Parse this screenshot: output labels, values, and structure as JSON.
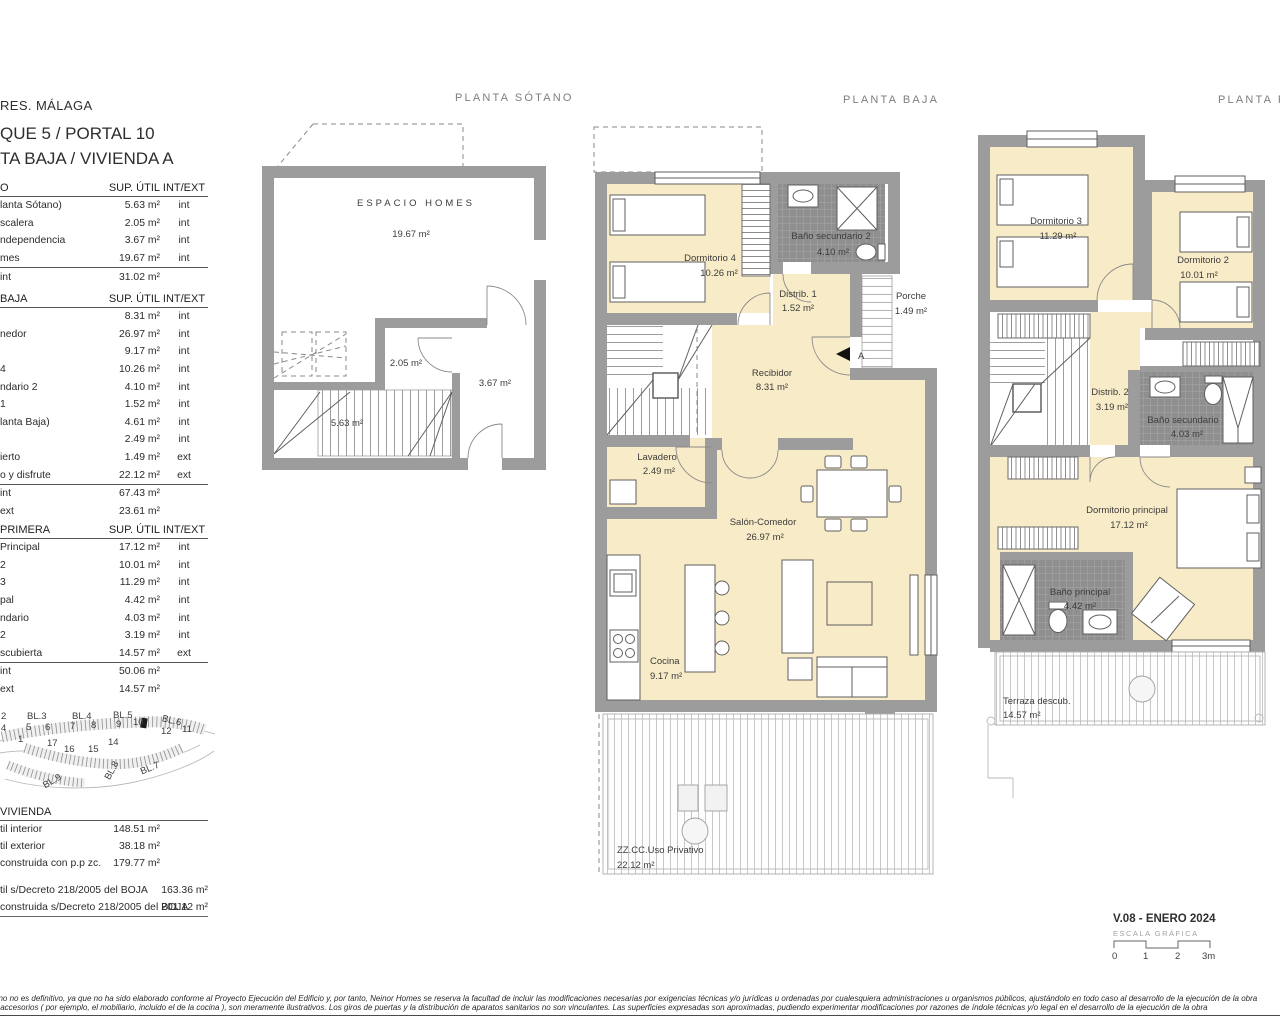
{
  "headers": {
    "sotano": "PLANTA SÓTANO",
    "baja": "PLANTA BAJA",
    "primera": "PLANTA PRIMERA"
  },
  "panel": {
    "project": "RES. MÁLAGA",
    "title_block": "QUE 5 / PORTAL 10",
    "title_unit": "TA BAJA / VIVIENDA A",
    "cols": {
      "sup": "SUP. ÚTIL",
      "zone": "INT/EXT"
    },
    "sotano": {
      "header": "O",
      "rows": [
        {
          "label": "lanta Sótano)",
          "value": "5.63 m²",
          "zone": "int"
        },
        {
          "label": "scalera",
          "value": "2.05 m²",
          "zone": "int"
        },
        {
          "label": "ndependencia",
          "value": "3.67 m²",
          "zone": "int"
        },
        {
          "label": "mes",
          "value": "19.67 m²",
          "zone": "int"
        }
      ],
      "totals": [
        {
          "label": "int",
          "value": "31.02 m²"
        }
      ]
    },
    "baja": {
      "header": "BAJA",
      "rows": [
        {
          "label": "",
          "value": "8.31 m²",
          "zone": "int"
        },
        {
          "label": "nedor",
          "value": "26.97 m²",
          "zone": "int"
        },
        {
          "label": "",
          "value": "9.17 m²",
          "zone": "int"
        },
        {
          "label": "4",
          "value": "10.26 m²",
          "zone": "int"
        },
        {
          "label": "ndario 2",
          "value": "4.10 m²",
          "zone": "int"
        },
        {
          "label": "1",
          "value": "1.52 m²",
          "zone": "int"
        },
        {
          "label": "lanta Baja)",
          "value": "4.61 m²",
          "zone": "int"
        },
        {
          "label": "",
          "value": "2.49 m²",
          "zone": "int"
        },
        {
          "label": "ierto",
          "value": "1.49 m²",
          "zone": "ext"
        },
        {
          "label": "o y disfrute",
          "value": "22.12 m²",
          "zone": "ext"
        }
      ],
      "totals": [
        {
          "label": "int",
          "value": "67.43 m²"
        },
        {
          "label": "ext",
          "value": "23.61 m²"
        }
      ]
    },
    "primera": {
      "header": "PRIMERA",
      "rows": [
        {
          "label": "Principal",
          "value": "17.12 m²",
          "zone": "int"
        },
        {
          "label": "2",
          "value": "10.01 m²",
          "zone": "int"
        },
        {
          "label": "3",
          "value": "11.29 m²",
          "zone": "int"
        },
        {
          "label": "pal",
          "value": "4.42 m²",
          "zone": "int"
        },
        {
          "label": "ndario",
          "value": "4.03 m²",
          "zone": "int"
        },
        {
          "label": "2",
          "value": "3.19 m²",
          "zone": "int"
        },
        {
          "label": "scubierta",
          "value": "14.57 m²",
          "zone": "ext"
        }
      ],
      "totals": [
        {
          "label": "int",
          "value": "50.06 m²"
        },
        {
          "label": "ext",
          "value": "14.57 m²"
        }
      ]
    },
    "vivienda": {
      "header": "VIVIENDA",
      "rows": [
        {
          "label": "til interior",
          "value": "148.51 m²"
        },
        {
          "label": "til exterior",
          "value": "38.18 m²"
        },
        {
          "label": "construida con p.p zc.",
          "value": "179.77 m²"
        }
      ],
      "boja": [
        {
          "label": "til s/Decreto 218/2005 del BOJA",
          "value": "163.36 m²"
        },
        {
          "label": "construida s/Decreto 218/2005 del BOJA",
          "value": "201.12 m²"
        }
      ]
    }
  },
  "siteplan": {
    "blocks": [
      "2",
      "BL.3",
      "BL.4",
      "BL.5",
      "BL.6",
      "BL.7",
      "BL.8",
      "BL.9"
    ],
    "units": [
      "1",
      "4",
      "5",
      "6",
      "7",
      "8",
      "9",
      "10",
      "11",
      "12",
      "14",
      "15",
      "16",
      "17"
    ]
  },
  "plans": {
    "sotano": {
      "name": "ESPACIO HOMES",
      "area": "19.67 m²",
      "escalera": "2.05 m²",
      "independencia": "3.67 m²",
      "escalera_sotano": "5.63 m²"
    },
    "baja": {
      "marker": "A",
      "dorm4": {
        "name": "Dormitorio 4",
        "area": "10.26 m²"
      },
      "bano2": {
        "name": "Baño secundario 2",
        "area": "4.10 m²"
      },
      "distrib1": {
        "name": "Distrib. 1",
        "area": "1.52 m²"
      },
      "porche": {
        "name": "Porche",
        "area": "1.49 m²"
      },
      "recibidor": {
        "name": "Recibidor",
        "area": "8.31 m²"
      },
      "lavadero": {
        "name": "Lavadero",
        "area": "2.49 m²"
      },
      "salon": {
        "name": "Salón-Comedor",
        "area": "26.97 m²"
      },
      "cocina": {
        "name": "Cocina",
        "area": "9.17 m²"
      },
      "terraza": {
        "name": "ZZ.CC.Uso Privativo",
        "area": "22.12 m²"
      }
    },
    "primera": {
      "dorm3": {
        "name": "Dormitorio 3",
        "area": "11.29 m²"
      },
      "dorm2": {
        "name": "Dormitorio 2",
        "area": "10.01 m²"
      },
      "distrib2": {
        "name": "Distrib. 2",
        "area": "3.19 m²"
      },
      "bano_sec": {
        "name": "Baño secundario",
        "area": "4.03 m²"
      },
      "dorm_ppal": {
        "name": "Dormitorio principal",
        "area": "17.12 m²"
      },
      "bano_ppal": {
        "name": "Baño principal",
        "area": "4.42 m²"
      },
      "terraza": {
        "name": "Terraza descub.",
        "area": "14.57 m²"
      }
    }
  },
  "version": {
    "line": "V.08 - ENERO 2024",
    "scale": "ESCALA GRÁFICA",
    "ticks": [
      "0",
      "1",
      "2",
      "3m"
    ]
  },
  "disclaimer": {
    "line1": "ano no es definitivo, ya que no ha sido elaborado conforme al Proyecto Ejecución del Edificio y, por tanto, Neinor Homes se reserva la facultad de incluir las modificaciones necesarias por exigencias técnicas y/o jurídicas u ordenadas por cualesquiera administraciones u organismos públicos, ajustándolo en todo caso al desarrollo de la ejecución de la obra",
    "line2": "s accesorios  ( por ejemplo, el mobiliario, incluido el de la cocina ),  son meramente ilustrativos.  Los giros de puertas  y  la distribución de aparatos sanitarios no son vinculantes.  Las superficies  expresadas son aproximadas,  pudiendo  experimentar modificaciones por razones de índole técnicas y/o legal en el desarrollo de la ejecución de la obra"
  }
}
